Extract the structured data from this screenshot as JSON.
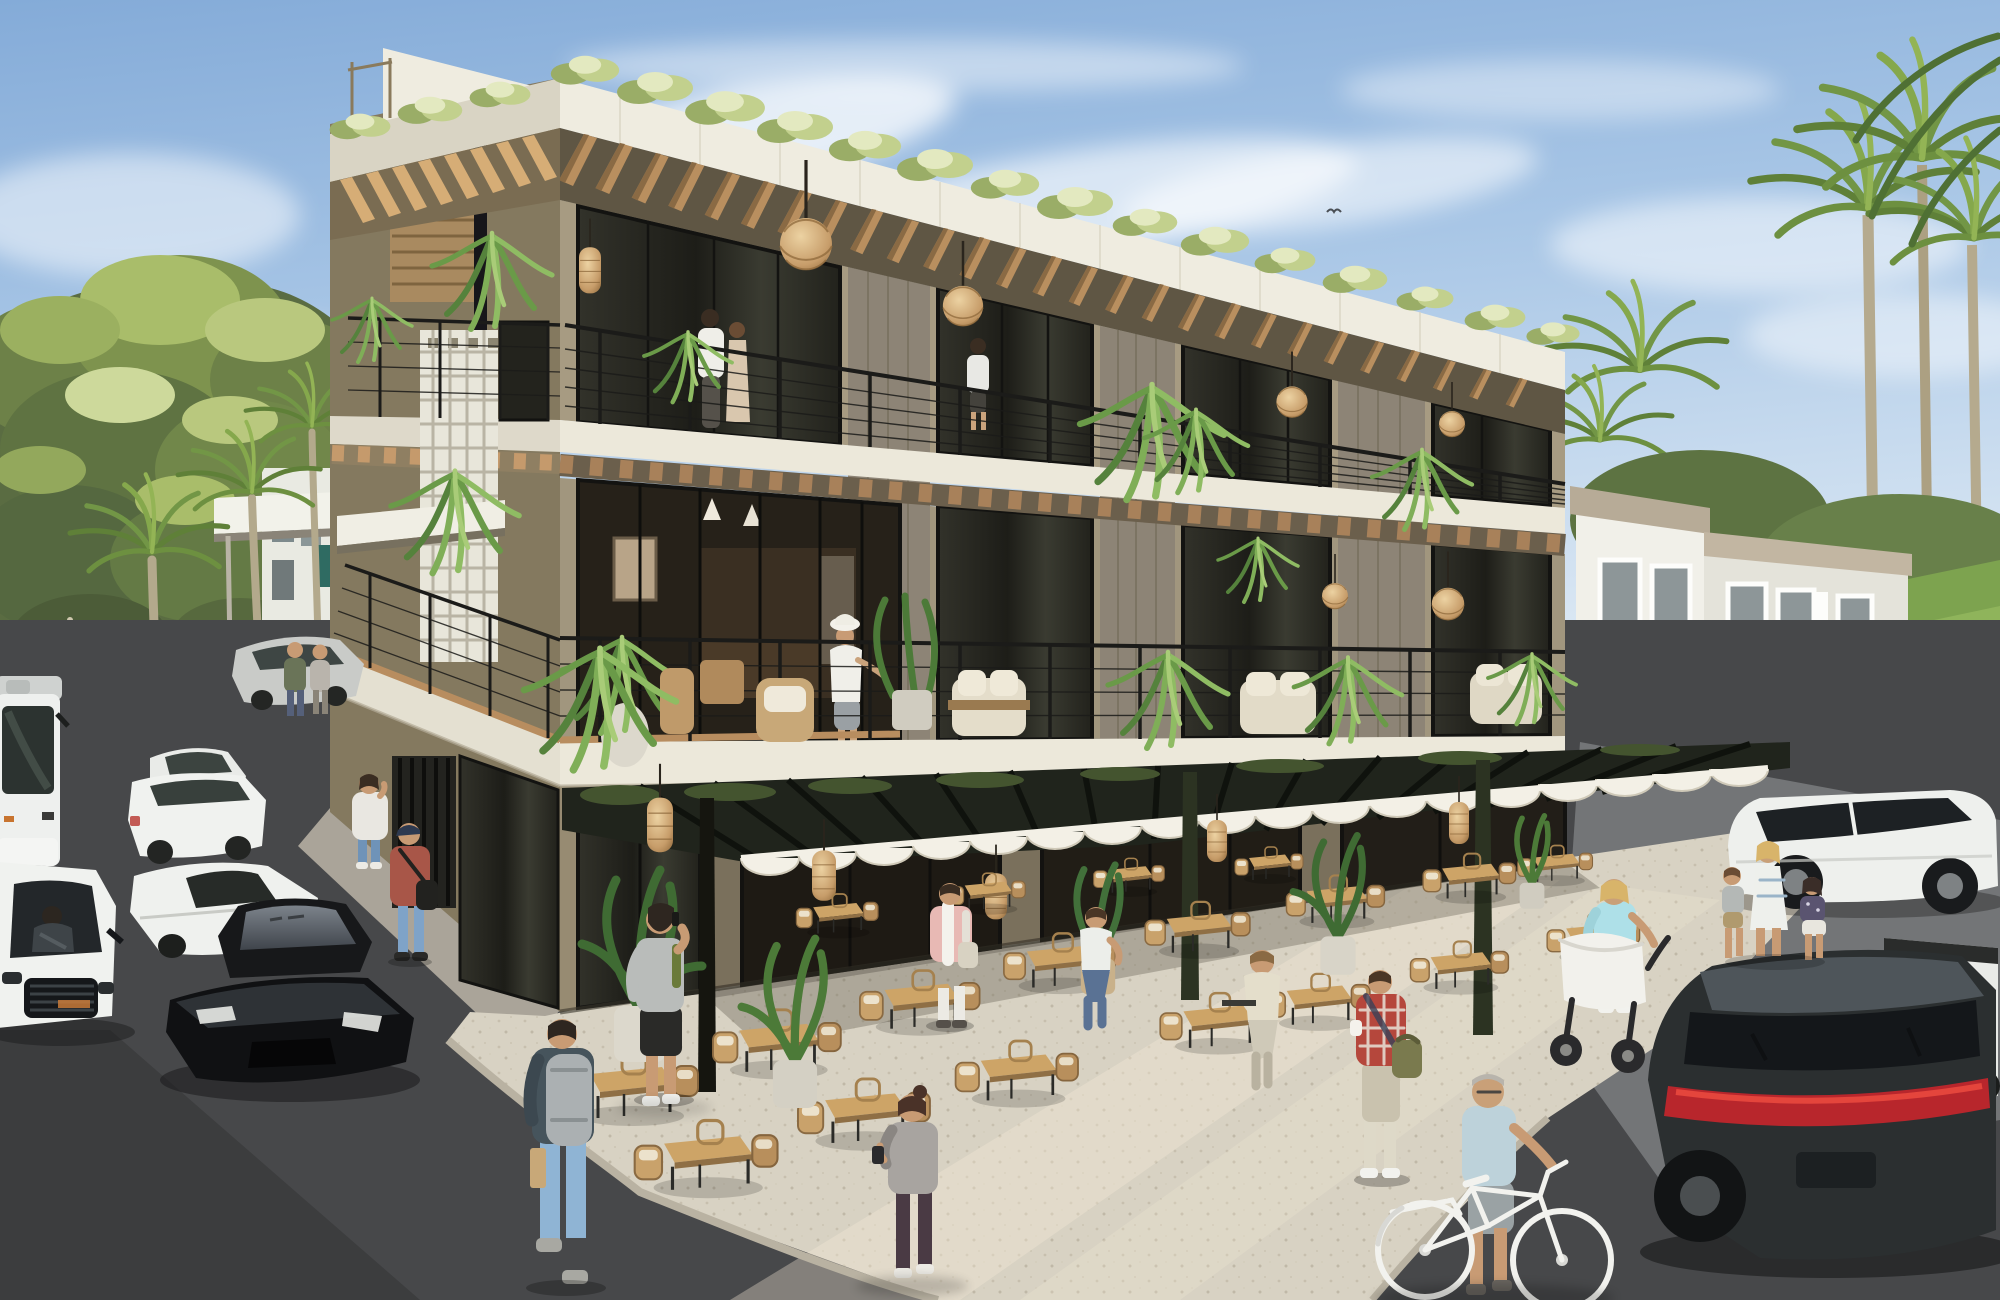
{
  "meta": {
    "title": "Architectural rendering — three-story boutique mixed-use building with ground-floor restaurant terrace, street parking and tropical landscaping",
    "render_type": "photorealistic 3D exterior visualization",
    "time_of_day": "sunny daytime",
    "camera": "elevated three-quarter corner view"
  },
  "palette": {
    "sky_top": "#8fb4dd",
    "sky_low": "#d9e6f2",
    "cloud": "#ffffff",
    "stucco_lit": "#a79b82",
    "stucco_shade": "#84795f",
    "slab_white": "#ece8da",
    "timber_beam": "#b98f5f",
    "timber_deck": "#b88d5f",
    "plank_pier_gray": "#8d8476",
    "glass_dark": "#24241e",
    "railing_black": "#1b1b19",
    "pergola_steel": "#20241c",
    "awning_white": "#f3f0e6",
    "plaza_concrete": "#d8d2c3",
    "asphalt": "#47484a",
    "foliage_dark": "#4c5c38",
    "foliage_light": "#a9bd6a",
    "lawn": "#7da34f",
    "rattan": "#d3ad79",
    "accent_red_taillight": "#c0262c"
  },
  "building": {
    "floors": 3,
    "roof": [
      "white fascia band",
      "flowering rooftop hedge",
      "exposed timber pergola beams",
      "stair-core tower with white cap and timber slats"
    ],
    "facade": [
      "olive-taupe stucco",
      "white concrete slab bands between floors",
      "vertical gray timber-plank piers between units",
      "white breeze-block lattice screen",
      "black vertical-slat ground screen",
      "black cable balcony railings",
      "hanging ferns",
      "rattan ball pendant lamps"
    ],
    "second_floor": "wrap-around wood-deck terrace with wicker lounge chairs, white sofas and potted plants",
    "ground_floor": "full-height dark glass storefronts under black steel pergola with white scalloped awning and rattan cylinder lanterns"
  },
  "restaurant_terrace": {
    "tables": "≈18 square light-timber tables",
    "chairs": "rattan rope dining chairs with cream cushions",
    "planters": "large banana / bird-of-paradise plants in white concrete pots",
    "ground": "light speckled concrete plaza"
  },
  "people": [
    {
      "id": "balcony-couple",
      "desc": "couple standing on top-floor corner balcony, man in white shirt, woman in beige dress"
    },
    {
      "id": "balcony-man",
      "desc": "man at top-floor middle balcony railing"
    },
    {
      "id": "terrace-woman-hat",
      "desc": "woman in white bucket hat, tee and shorts on second-floor terrace"
    },
    {
      "id": "bearded-phone-man",
      "desc": "bearded man in gray tee and black shorts talking on phone by corner storefront"
    },
    {
      "id": "pink-shirt-man",
      "desc": "man in pink shirt and white trousers walking into terrace"
    },
    {
      "id": "seated-guest-1",
      "desc": "man in white tee seated at terrace table"
    },
    {
      "id": "seated-guest-2",
      "desc": "man in beige shirt seated at table with device"
    },
    {
      "id": "plaid-shirt-man",
      "desc": "man in red plaid shirt with olive messenger bag crossing plaza"
    },
    {
      "id": "bun-woman",
      "desc": "woman with hair bun, gray tee and dark leggings checking phone"
    },
    {
      "id": "backpack-man",
      "desc": "man with gray backpack, blue jacket and jeans walking in foreground"
    },
    {
      "id": "red-cap-man",
      "desc": "man in dusty-red tee, cap and shoulder bag on left sidewalk"
    },
    {
      "id": "hoodie-woman",
      "desc": "woman in white hoodie and jeans on phone beside parked cars"
    },
    {
      "id": "sidewalk-pair",
      "desc": "two pedestrians farther up the left sidewalk"
    },
    {
      "id": "elderly-cyclist",
      "desc": "gray-haired man in light-blue tee pushing a white city bicycle"
    },
    {
      "id": "stroller-woman",
      "desc": "woman in light-blue top pushing white baby pram"
    },
    {
      "id": "family-trio",
      "desc": "mother holding hands with boy and girl walking toward white SUV"
    },
    {
      "id": "suv-driver",
      "desc": "driver visible through Range Rover windshield"
    }
  ],
  "vehicles": [
    {
      "id": "tour-bus",
      "desc": "white coach bus far left"
    },
    {
      "id": "white-sedans",
      "desc": "two white sedans parked along left street"
    },
    {
      "id": "silver-sedan",
      "desc": "silver sedan farther up the street"
    },
    {
      "id": "white-supercar",
      "desc": "low white sports car parked mid-left"
    },
    {
      "id": "black-gtr",
      "desc": "glossy black sports coupe parked at left curb"
    },
    {
      "id": "white-range-rover",
      "desc": "white SUV with honeycomb grille, lower-left corner"
    },
    {
      "id": "white-suv-right",
      "desc": "white luxury SUV parked by neighboring building"
    },
    {
      "id": "white-pickup",
      "desc": "white pickup truck bed at right edge"
    },
    {
      "id": "dark-audi-suv",
      "desc": "dark gray SUV with red LED tail bar, bottom-right"
    }
  ],
  "context": {
    "left": "dense tropical trees and fan palms, glimpse of white neighbor building with entry canopy",
    "right": "white three-story neighbor building with taupe parapet caps, drive-through canopy, lawn and tall palms",
    "sky_detail": "single small bird high over right wing"
  }
}
